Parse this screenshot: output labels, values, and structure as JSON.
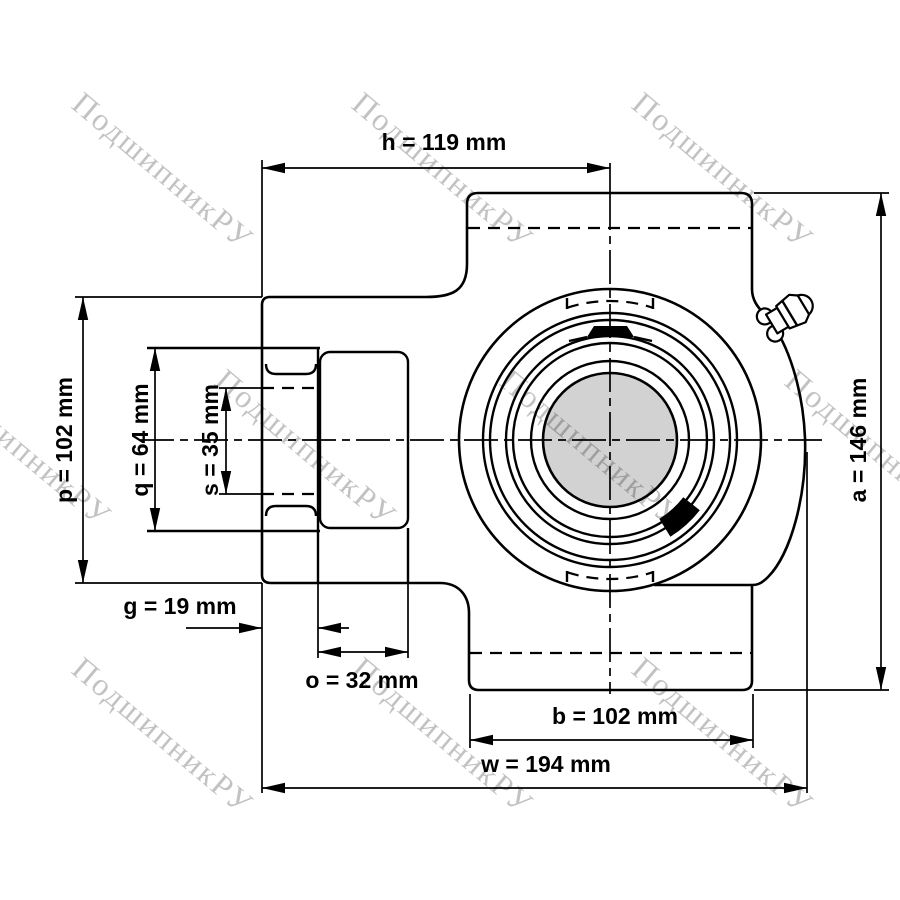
{
  "drawing": {
    "type": "bearing-unit-dimensional-drawing",
    "line_color": "#000000",
    "bore_fill_color": "#d2d2d2",
    "watermark_color": "rgba(0,0,0,0.24)"
  },
  "dimensions": {
    "h": {
      "name": "h",
      "value": 119,
      "unit": "mm",
      "label": "h = 119 mm"
    },
    "p": {
      "name": "p",
      "value": 102,
      "unit": "mm",
      "label": "p = 102 mm"
    },
    "q": {
      "name": "q",
      "value": 64,
      "unit": "mm",
      "label": "q = 64 mm"
    },
    "s": {
      "name": "s",
      "value": 35,
      "unit": "mm",
      "label": "s = 35 mm"
    },
    "g": {
      "name": "g",
      "value": 19,
      "unit": "mm",
      "label": "g = 19 mm"
    },
    "o": {
      "name": "o",
      "value": 32,
      "unit": "mm",
      "label": "o = 32 mm"
    },
    "b": {
      "name": "b",
      "value": 102,
      "unit": "mm",
      "label": "b = 102 mm"
    },
    "w": {
      "name": "w",
      "value": 194,
      "unit": "mm",
      "label": "w = 194 mm"
    },
    "a": {
      "name": "a",
      "value": 146,
      "unit": "mm",
      "label": "a = 146 mm"
    }
  },
  "watermarks": {
    "text": "ПодшипникРУ",
    "angle_deg": 40,
    "positions": [
      [
        70,
        107
      ],
      [
        350,
        107
      ],
      [
        630,
        107
      ],
      [
        -72,
        384
      ],
      [
        213,
        384
      ],
      [
        498,
        384
      ],
      [
        783,
        384
      ],
      [
        70,
        672
      ],
      [
        350,
        672
      ],
      [
        630,
        672
      ]
    ]
  }
}
